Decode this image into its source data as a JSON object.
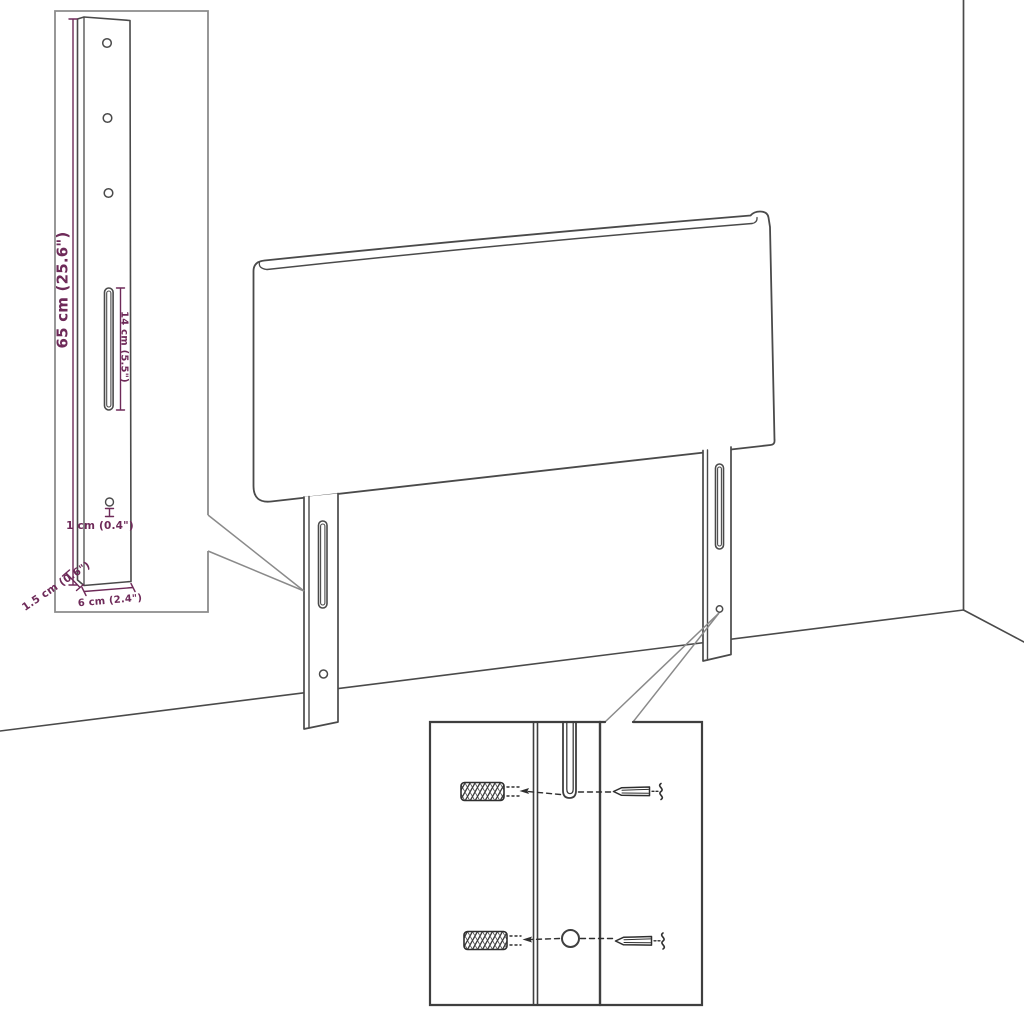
{
  "diagram": {
    "colors": {
      "background": "#ffffff",
      "line": "#4a4a4a",
      "dimension": "#6e2a59",
      "inset_border": "#8c8c8c",
      "callout": "#8a8a8a",
      "detail_border": "#3f3f3f",
      "hardware": "#2f2f2f"
    },
    "inset": {
      "dimensions": {
        "height": "65 cm (25.6\")",
        "slot": "14 cm (5.5\")",
        "hole": "1 cm (0.4\")",
        "depth": "1.5 cm (0.6\")",
        "width": "6 cm (2.4\")"
      }
    },
    "hardware_detail": {
      "icons": [
        "wall-plug-icon",
        "screw-icon"
      ]
    }
  }
}
